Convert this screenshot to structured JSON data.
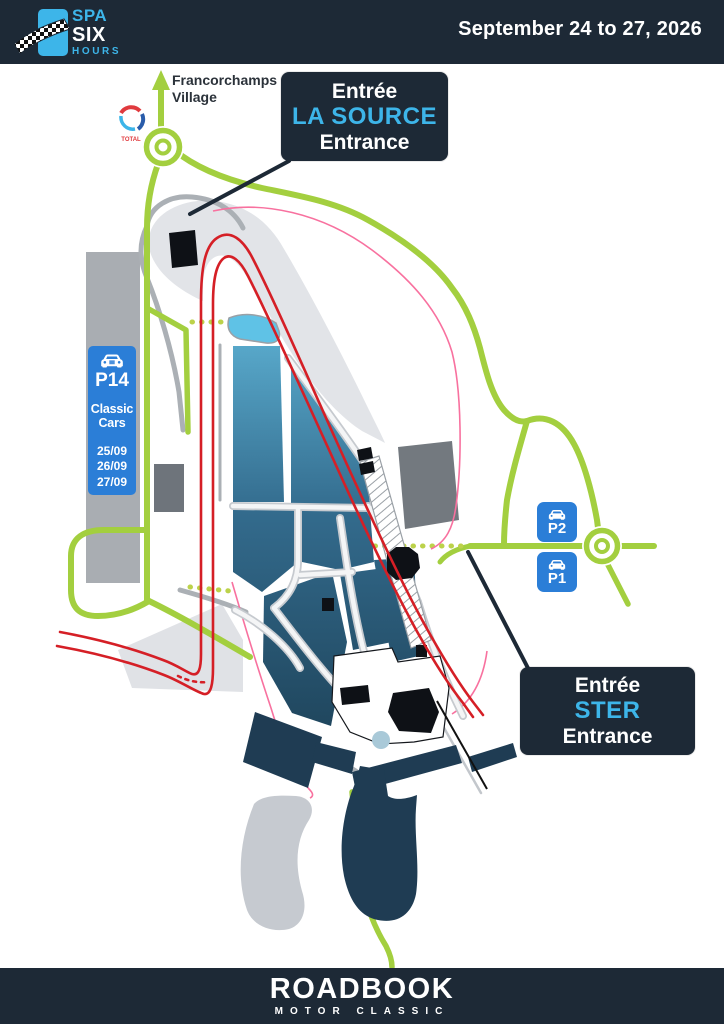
{
  "header": {
    "logo": {
      "word1": "SPA",
      "word2": "SIX",
      "word3": "HOURS"
    },
    "date_range": "September 24 to 27, 2026"
  },
  "map": {
    "village_label": {
      "line1": "Francorchamps",
      "line2": "Village"
    },
    "fuel_station_label": "TOTAL",
    "entrances": {
      "la_source": {
        "entree": "Entrée",
        "name": "LA SOURCE",
        "entrance": "Entrance"
      },
      "ster": {
        "entree": "Entrée",
        "name": "STER",
        "entrance": "Entrance"
      }
    },
    "parkings": {
      "p14": {
        "code": "P14",
        "category_line1": "Classic",
        "category_line2": "Cars",
        "dates": [
          "25/09",
          "26/09",
          "27/09"
        ]
      },
      "p2": {
        "code": "P2"
      },
      "p1": {
        "code": "P1"
      }
    },
    "colors": {
      "navy": "#1D2936",
      "cyan": "#3DB5E9",
      "green": "#A3CF3F",
      "red": "#D51F26",
      "parking_blue": "#2B7ED7",
      "pink": "#F8719F"
    }
  },
  "footer": {
    "brand": "ROADBOOK",
    "tagline": "MOTOR CLASSIC"
  }
}
